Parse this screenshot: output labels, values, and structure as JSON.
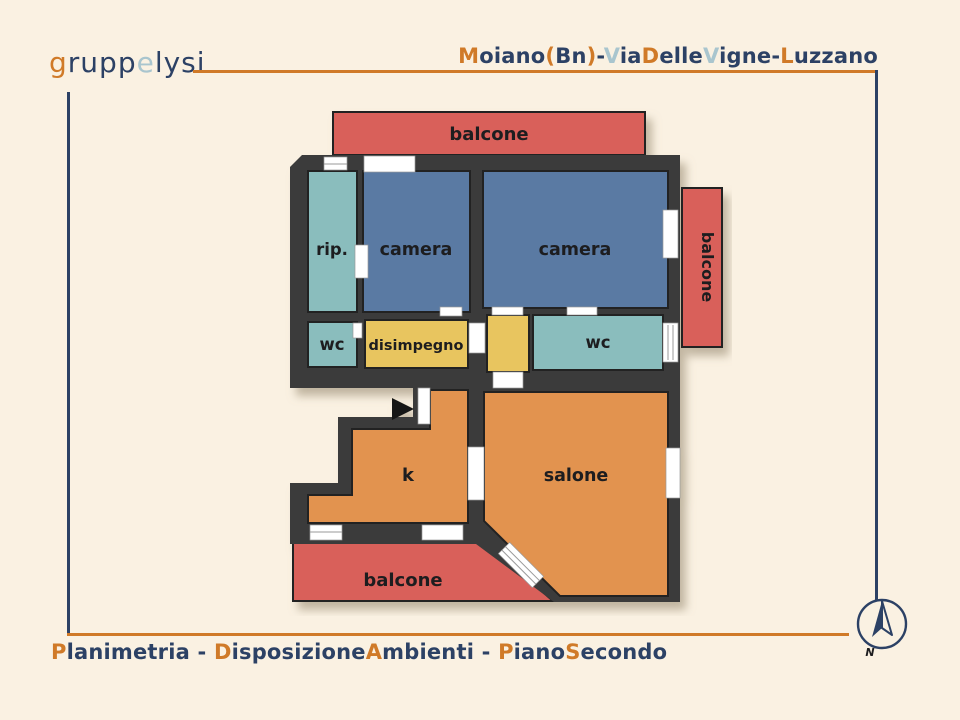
{
  "header": {
    "logo": {
      "segments": [
        {
          "text": "g"
        },
        {
          "text": "rupp"
        },
        {
          "text": "e"
        },
        {
          "text": "lysi"
        }
      ]
    },
    "title": {
      "segments": [
        {
          "text": "M"
        },
        {
          "text": "oiano"
        },
        {
          "text": "("
        },
        {
          "text": "Bn"
        },
        {
          "text": ")"
        },
        {
          "text": "-"
        },
        {
          "text": "V"
        },
        {
          "text": "ia"
        },
        {
          "text": "D"
        },
        {
          "text": "elle"
        },
        {
          "text": "V"
        },
        {
          "text": "igne"
        },
        {
          "text": "-"
        },
        {
          "text": "L"
        },
        {
          "text": "uzzano"
        }
      ]
    }
  },
  "footer": {
    "caption": {
      "segments": [
        {
          "text": "P"
        },
        {
          "text": "lanimetria"
        },
        {
          "text": " - "
        },
        {
          "text": "D"
        },
        {
          "text": "isposizione"
        },
        {
          "text": "A"
        },
        {
          "text": "mbienti"
        },
        {
          "text": " - "
        },
        {
          "text": "P"
        },
        {
          "text": "iano"
        },
        {
          "text": "S"
        },
        {
          "text": "econdo"
        }
      ]
    }
  },
  "compass": {
    "north_label": "N"
  },
  "plan": {
    "rooms": [
      {
        "id": "balcone-top",
        "label": "balcone"
      },
      {
        "id": "rip",
        "label": "rip."
      },
      {
        "id": "camera-1",
        "label": "camera"
      },
      {
        "id": "camera-2",
        "label": "camera"
      },
      {
        "id": "balcone-right",
        "label": "balcone"
      },
      {
        "id": "wc-1",
        "label": "wc"
      },
      {
        "id": "disimpegno",
        "label": "disimpegno"
      },
      {
        "id": "wc-2",
        "label": "wc"
      },
      {
        "id": "k",
        "label": "k"
      },
      {
        "id": "salone",
        "label": "salone"
      },
      {
        "id": "balcone-bottom",
        "label": "balcone"
      }
    ],
    "colors": {
      "wall": "#3b3b3b",
      "balcony": "#d9605a",
      "bedroom": "#5a7aa3",
      "service": "#8abdbd",
      "hallway": "#e8c55f",
      "living": "#e2934f",
      "accent_orange": "#d07a28",
      "navy": "#2c4165",
      "light_blue": "#a9c5ce",
      "background": "#faf1e2",
      "label": "#1d1d1f"
    }
  }
}
